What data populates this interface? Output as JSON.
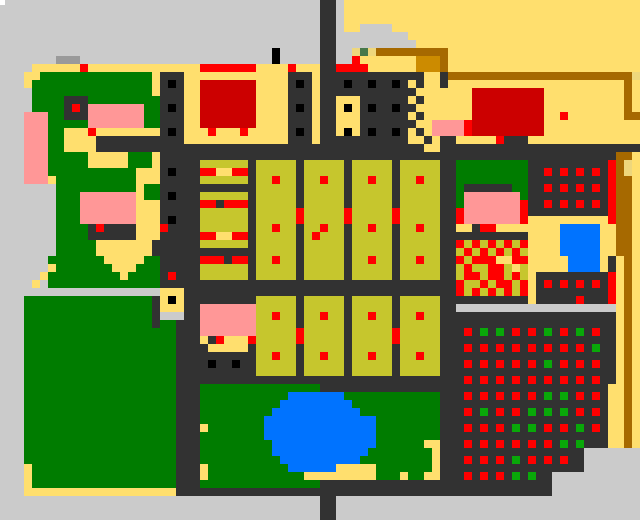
{
  "map": {
    "cols": 80,
    "rows_count": 65,
    "cell_px": 8,
    "palette": {
      ".": "#cbcbcb",
      "g": "#9a9a9a",
      "Y": "#ffdf6e",
      "K": "#eed77c",
      "O": "#c6c62d",
      "E": "#007c00",
      "V": "#09a809",
      "T": "#47784a",
      "d": "#323232",
      "k": "#000000",
      "R": "#ff0000",
      "r": "#cc0000",
      "P": "#ff9797",
      "B": "#0073ff",
      "N": "#a66900",
      "o": "#cc8b00",
      "W": "#ffffff"
    },
    "legend": {
      ".": "background-gray",
      "g": "medium-gray-strip",
      "Y": "yellow-district",
      "K": "khaki-patch",
      "O": "olive-city-block",
      "E": "park-green",
      "V": "green-dot",
      "T": "dark-green-pixel",
      "d": "road-dark",
      "k": "black-window",
      "R": "red-dot",
      "r": "dark-red-building",
      "P": "pink-building",
      "B": "water-blue",
      "N": "brown-road",
      "o": "orange-building"
    },
    "rows": [
      "........................................dd.YYYYYYYYYYYYYYYYYYYYYYYYYYYYYYYYYYYYY",
      "........................................dd.YYYYYYYYYYYYYYYYYYYYYYYYYYYYYYYYYYYYY",
      "........................................dd.YYYYYYYYYYYYYYYYYYYYYYYYYYYYYYYYYYYYY",
      "........................................dd.YY....YYYYYYYYYYYYYYYYYYYYYYYYYYYYYYY",
      "........................................dd.........YYYYYYYYYYYYYYYYYYYYYYYYYYYYY",
      "........................................dd..........YYYYYYYYYYYYYYYYYYYYYYYYYYYY",
      "..................................k.....dd..KTKNNNNNNNNNYYYYYYYYYYYYYYYYYYYYYYYY",
      ".......ggg........................k.....dd..RYYYYYYYoooNYYYYYYYYYYYYYYYYYYYYYYYY",
      "....YYYYYYRYYYYYYYYYYYYYYRRRRRRRYYYYRYYYddRRRRYYYYYYoooNYYYYYYYYYYYYYYYYYYYYYYYY",
      "...YYEEEEEEEEEEEEEEYdddYYYYYYYYYYYYYdddYdddddddddddddYYdNNNNNNNNNNNNNNNNNNNNNNNK",
      "...YEEEEEEEEEEEEEEEYdkdYYrrrrrrrYYYYdkdYdddkddkddkdYdYYdYYYYYYYYYYYYYYYYYYYYYYNY",
      "....EEEEEEEEEEEEEEEYdddYYrrrrrrrYYYYdddYddddddddddddYYYYYYYrrrrrrrrrYYYYYYYYYYNY",
      "....EEEEdddEEEEEEEEEdddYYrrrrrrrYYYYdddYddYYYddddddYdYYYYYYrrrrrrrrrYYYYYYYYYYNY",
      "....EEEEdRdPPPPPPPEEdkdYYrrrrrrrYYYYdkdYddYkYdkddkddYYYYYYYrrrrrrrrrYYYYYYYYYYNY",
      "...PPPEEdddPPPPPPPEEdddYYrrrrrrrYYYYdddYddYYYddddddYdYYYYYYrrrrrrrrrYYRYYYYYYYNN",
      "...PPPEEEEEPPPPPPPEEdddYYrrrrrrrYYYYdddYddYYYdddddddYYPPPPRrrrrrrrrrYYYYYYYYYYYY",
      "...PPPEEYYYRYYYYYYYYdkdYYYRYYYRYYYYYdkdYddYkYdkddkdYdYPPPPRrrrrrrrrrYYYYYYYYYYYY",
      "...PPPEEYYYYdddddddddddYYYYYYYYYYYYYdddYdddddddddddYYdYddYYYYYRdddYYYYYYYYYYYYYY",
      "...PPPEEYYYYdddddddddddddddddddddddddddddddddddddddddYYddddddddddddddddddddddddd",
      "...PPPEEEEEYYYYYEEEYdddddddddddddddddddddddddddddddddddddddddddddddddddddddddNNY",
      "...PPPEEEEEYYYYYEEEYdddddOOOOOOdOOOOOdOOOOOdOOOOOdOOOOOddEEEEEEEEEddddddddddRNKY",
      "...PPPEEEEEEEEEEEYYYdkdddRRYYRRdOOOOOdOOOOOdOOOOOdOOOOOddEEEEEEEEEddRdRdRdRdRNKY",
      "...PPPYEEEEEEEEEEYYYdddddOOOOOOdOOROOdOOROOdOOROOdOOROOddEEEEEEEEEddddddddddRNNY",
      ".......EEEEEEEEEEYEEddddddddddddOOOOOdOOOOOdOOOOOdOOOOOddEddddddEEddRdRdRdRdRNNY",
      ".......EEEPPPPPPPYEEdkdddOOOOOOdOOOOOdOOOOOdOOOOOdOOOOOddEPPPPPPPEddddddddddRNNY",
      ".......EEEPPPPPPPYYYdddddRRdRRRdOOOOOdOOOOOdOOOOOdOOOOOddEPPPPPPPRddRdRdRdRdRNNY",
      ".......EEEPPPPPPPYYYdddddOOOOOOdOOOOOROOOOOROOOOOROOOOOddRPPPPPPPRddddddddddRNNY",
      ".......EEEPPPPPPPYYYdkdddOOOOOOdOOOOOROOOOOROOOOOROOOOOddRPPPPPPPRYYYYYYYYYYRNNY",
      ".......EEEEdRddddYYYRddddOOOOOOdOOROOdOOROOdOOROOdOOROOddYYdRRYYYYYYYYBBBBBYYNNY",
      ".......EEEEddddddYYYdddddRRYYRRdOOOOOdOROOOdOOOOOdOOOOOdddddddddddYYYYBBBBBYYNNY",
      ".......EEEEEYYYYYYYddddddOOOOOOdOOOOOdOOOOOdOOOOOdOOOOOddRORORORORYYYYBBBBBYYNNY",
      ".......EEEEEYYYYYYYdddddddddddddOOOOOdOOOOOdOOOOOdOOOOOddOROROROROYYYYBBBBBYYNNY",
      "......EEEEEEEYYYYYEEdddddRRRdRRdOOROOdOOOOOdOOROOdOOROOddRORRRYYRRYYYYYBBBBYdYNY",
      "......YEEEEEEEYYYEEEdddddOOOOOOdOOOOOdOOOOOdOOOOOdOOOOOddOROORROYOYYYYYBBBBYdYNY",
      ".....YEEEEEEEEEYEEEEdRdddOOOOOOdOOOOOdOOOOOdOOOOOdOOOOOddORRORROROYdddddddddRYNY",
      "....Y.EEEEEEEEEEEEEEdddddddddddddddddddddddddddddddddddddROORORRORYdRdRdRdRdRYNY",
      "....................YYYddddddddddddddddddddddddddddddddddRORORORORYdddddddddRYNY",
      "...EEEEEEEEEEEEEEEEdYkYdddddddddOOOOOdOOOOOdOOOOOdOOOOOdddddddddddYdddddRdddRYNY",
      "...EEEEEEEEEEEEEEEEdYYYddPPPPPPPOOOOOdOOOOOdOOOOOdOOOOOdd....................YNY",
      "...EEEEEEEEEEEEEEEEd...ddPPPPPPPOOROOdOOROOdOOROOdOOROOddddddddddddddddddddddYNY",
      "...EEEEEEEEEEEEEEEEdEEdddPPPPPPPOOOOOdOOOOOdOOOOOdOOOOOddddddddddddddddddddddYNY",
      "...EEEEEEEEEEEEEEEEEEEdddPPPPPPPOOOOOROOOOOdOOOOOROOOOOdddRdVdVdRdRdVdRdVdRddYNY",
      "...EEEEEEEEEEEEEEEEEEEdddYdRYYYROOOOOROOOOOdOOOOOROOOOOddddddddddddddddddddddYNY",
      "...EEEEEEEEEEEEEEEEEEEddddYYYYYdOOOOOdOOOOOdOOOOOdOOOOOdddRdRdRdRdRdRdRdRdVddYNY",
      "...EEEEEEEEEEEEEEEEEEEddddddddddOOROOdOOROOdOOROOdOOROOddddddddddddddddddddddYNY",
      "...EEEEEEEEEEEEEEEEEEEddddkddkddOOOOOdOOOOOdOOOOOdOOOOOdddRdRdRdRdRdVdRdRdRddYNY",
      "...EEEEEEEEEEEEEEEEEEEddddddddddOOOOOdOOOOOdOOOOOdOOOOOddddddddddddddddddddddYNY",
      "...EEEEEEEEEEEEEEEEEEEddddddddddddddddddddddddddddddddddddRdRdRdRdRdRdRdRdRddYNY",
      "...EEEEEEEEEEEEEEEEEEEdddEEEEEEEEEEEEEEEddddddddddddddddddddddddddddddddddddYYNY",
      "...EEEEEEEEEEEEEEEEEEEdddEEEEEEEEEEEBBBBBBBEEEEEEEEEEEEdddRdRdRdRdRdVdVdRdRdYYNY",
      "...EEEEEEEEEEEEEEEEEEEdddEEEEEEEEEEBBBBBBBBBEEEEEEEEEEEdddddddddddddddddddddYYNY",
      "...EEEEEEEEEEEEEEEEEEEdddEEEEEEEEEBBBBBBBBBBBEEEEEEEEEEdddRdVdRdRdVdVdVdRdRdYYNY",
      "...EEEEEEEEEEEEEEEEEEEdddEEEEEEEEBBBBBBBBBBBBBBEEEEEEEEdddddddddddddddddddddYYNY",
      "...EEEEEEEEEEEEEEEEEEEdddYEEEEEEEBBBBBBBBBBBBBBEEEEEEEEdddRdRdRdVdVdRdRdVdRdYYNY",
      "...EEEEEEEEEEEEEEEEEEEdddEEEEEEEEBBBBBBBBBBBBBBEEEEEEEEdddddddddddddddddddddYYNY",
      "...EEEEEEEEEEEEEEEEEEEdddEEEEEEEEEBBBBBBBBBBBBBEEEEEEYYdddRdRdRdRdRdRdVdVdddYYNY",
      "...EEEEEEEEEEEEEEEEEEEdddEEEEEEEEEBBBBBBBBBBBBEEEEEEEEYdddddddddddddddddd.......",
      "...EEEEEEEEEEEEEEEEEEEdddEEEEEEEEEEBBBBBBBBBBEEEEEEEEEYdddRdRdRdVdRdRdRdd.......",
      "...YEEEEEEEEEEEEEEEEEEdddYEEEEEEEEEEBBBBBBYYYYYEEEEEEEYdddddddddddddddddd.......",
      "...YEEEEEEEEEEEEEEEEEEdddYEEEEEEEEEEEEYYYYYYYYYEEEYEEYYdddRdRdRdVdVdd...........",
      "...YEEEEEEEEEEEEEEEEEEdddEEEEEEEEEEEEEEEddddddddddddddddddddddddddddd...........",
      "...YYYYYYYYYYYYYYYYYYYddddddddddddddddddddddddddddddddddddddddddddddd...........",
      "........................................dd......................................",
      "........................................dd......................................",
      "........................................dd......................................"
    ],
    "overlays": [
      {
        "name": "corner-dot",
        "x": 0,
        "y": 0,
        "w": 5,
        "h": 5,
        "color": "#ffffff"
      }
    ]
  }
}
